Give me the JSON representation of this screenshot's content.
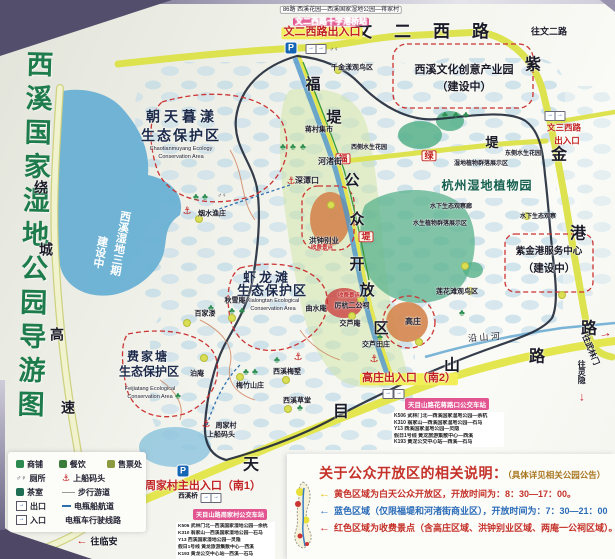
{
  "title": {
    "text": "西溪国家湿地公园导游图"
  },
  "colors": {
    "title_green": "#1e7c4c",
    "road_yellow": "#dde24f",
    "expressway_pale": "#eef0c2",
    "water_blue": "#69b0d4",
    "boundary_dark": "#1f2838",
    "paid_red": "#cc3333",
    "open_area_green": "#cde3a4",
    "badge_pink": "#e25590",
    "entrance_red": "#c22222"
  },
  "map": {
    "labels": [
      {
        "n": "road-wener-west",
        "t": "文二西路",
        "x": 433,
        "y": 32,
        "fs": 17,
        "ls": 22
      },
      {
        "n": "dir-to-wenerlu",
        "t": "往文二路",
        "x": 549,
        "y": 32,
        "fs": 9
      },
      {
        "n": "bus-note-top",
        "t": "86路 西溪花园—西溪国家湿地公园—蒋家村",
        "x": 341,
        "y": 10,
        "fs": 6,
        "b": 0,
        "bg": "#ffffff",
        "bd": "#aaaaaa"
      },
      {
        "n": "station-badge-top",
        "t": "文二西路十字港桥站",
        "x": 331,
        "y": 22,
        "fs": 8,
        "c": "#ffffff",
        "bg": "#e25590"
      },
      {
        "n": "entrance-wener",
        "t": "文二西路出入口",
        "x": 322,
        "y": 33,
        "fs": 11,
        "c": "#c22222",
        "bg": "#f2ee55"
      },
      {
        "n": "road-zijingang-1",
        "t": "紫",
        "x": 533,
        "y": 66,
        "fs": 16
      },
      {
        "n": "road-zijingang-2",
        "t": "金",
        "x": 559,
        "y": 156,
        "fs": 16
      },
      {
        "n": "road-zijingang-3",
        "t": "港",
        "x": 578,
        "y": 235,
        "fs": 16
      },
      {
        "n": "road-zijingang-4",
        "t": "路",
        "x": 589,
        "y": 330,
        "fs": 16
      },
      {
        "n": "creative-park-1",
        "t": "西溪文化创意产业园",
        "x": 464,
        "y": 71,
        "fs": 11
      },
      {
        "n": "creative-park-2",
        "t": "（建设中）",
        "x": 464,
        "y": 88,
        "fs": 11
      },
      {
        "n": "qianjinyang-bird-area",
        "t": "千金漾观鸟区",
        "x": 352,
        "y": 68,
        "fs": 7
      },
      {
        "n": "fudi-1",
        "t": "福",
        "x": 313,
        "y": 85,
        "fs": 15
      },
      {
        "n": "fudi-2",
        "t": "堤",
        "x": 334,
        "y": 118,
        "fs": 15
      },
      {
        "n": "fudi-badge-1",
        "t": "福",
        "x": 343,
        "y": 159,
        "fs": 9,
        "c": "#c22222",
        "bd": "#cc3333",
        "bg": "#fff8e8"
      },
      {
        "n": "fudi-badge-2",
        "t": "堤",
        "x": 366,
        "y": 237,
        "fs": 9,
        "c": "#c22222",
        "bd": "#cc3333",
        "bg": "#fff8e8"
      },
      {
        "n": "ludi-badge",
        "t": "绿",
        "x": 429,
        "y": 156,
        "fs": 9,
        "c": "#c22222",
        "bd": "#cc3333",
        "bg": "#fff8e8"
      },
      {
        "n": "ludi-di",
        "t": "堤",
        "x": 492,
        "y": 143,
        "fs": 13
      },
      {
        "n": "open-area-1",
        "t": "公",
        "x": 352,
        "y": 181,
        "fs": 15
      },
      {
        "n": "open-area-2",
        "t": "众",
        "x": 357,
        "y": 220,
        "fs": 15
      },
      {
        "n": "open-area-3",
        "t": "开",
        "x": 357,
        "y": 265,
        "fs": 15
      },
      {
        "n": "open-area-4",
        "t": "放",
        "x": 367,
        "y": 291,
        "fs": 15
      },
      {
        "n": "open-area-5",
        "t": "区",
        "x": 381,
        "y": 329,
        "fs": 15
      },
      {
        "n": "jiangcun-market",
        "t": "蒋村集市",
        "x": 319,
        "y": 130,
        "fs": 7
      },
      {
        "n": "hezhu-street",
        "t": "河渚街",
        "x": 330,
        "y": 162,
        "fs": 8
      },
      {
        "n": "shentankou",
        "t": "深潭口",
        "x": 307,
        "y": 181,
        "fs": 8
      },
      {
        "n": "west-water-garden",
        "t": "西侧水生花园",
        "x": 369,
        "y": 148,
        "fs": 6
      },
      {
        "n": "east-water-garden",
        "t": "东侧水生花园",
        "x": 523,
        "y": 154,
        "fs": 6
      },
      {
        "n": "wetland-plant-display",
        "t": "湿地植物群落展示区",
        "x": 481,
        "y": 164,
        "fs": 6
      },
      {
        "n": "botanical-garden",
        "t": "杭州湿地植物园",
        "x": 487,
        "y": 186,
        "fs": 12,
        "c": "#16604e",
        "ls": 1
      },
      {
        "n": "underwater-gallery",
        "t": "水下生态观察廊",
        "x": 451,
        "y": 207,
        "fs": 6
      },
      {
        "n": "aquatic-plant-display",
        "t": "水生植物群落展示区",
        "x": 440,
        "y": 224,
        "fs": 6
      },
      {
        "n": "underwater-observe",
        "t": "水下生态观察",
        "x": 538,
        "y": 217,
        "fs": 6
      },
      {
        "n": "entrance-wensan-1",
        "t": "文三西路",
        "x": 564,
        "y": 128,
        "fs": 8.5,
        "c": "#c22222"
      },
      {
        "n": "entrance-wensan-2",
        "t": "出入口",
        "x": 567,
        "y": 141,
        "fs": 8.5,
        "c": "#c22222"
      },
      {
        "n": "zjg-service-1",
        "t": "紫金港服务中心",
        "x": 549,
        "y": 252,
        "fs": 9.5
      },
      {
        "n": "zjg-service-2",
        "t": "（建设中）",
        "x": 549,
        "y": 269,
        "fs": 10.5
      },
      {
        "n": "lianhuatan-bird-area",
        "t": "莲花滩观鸟区",
        "x": 457,
        "y": 292,
        "fs": 7
      },
      {
        "n": "chaotianmuyang-1",
        "t": "朝天暮漾",
        "x": 182,
        "y": 117,
        "fs": 14,
        "c": "#1c2a4a",
        "ls": 4
      },
      {
        "n": "chaotianmuyang-2",
        "t": "生态保护区",
        "x": 181,
        "y": 136,
        "fs": 14,
        "c": "#1c2a4a",
        "ls": 2
      },
      {
        "n": "chaotianmuyang-en1",
        "t": "Chaotianmuyang Ecology",
        "x": 181,
        "y": 150,
        "fs": 5.5,
        "b": 0,
        "c": "#222233"
      },
      {
        "n": "chaotianmuyang-en2",
        "t": "Conservation Area",
        "x": 181,
        "y": 158,
        "fs": 5.5,
        "b": 0,
        "c": "#222233"
      },
      {
        "n": "phase3-1",
        "t": "西溪湿地三期",
        "x": 119,
        "y": 243,
        "fs": 11,
        "c": "#ffffff",
        "v": 1,
        "r": 10,
        "halo": 0
      },
      {
        "n": "phase3-2",
        "t": "建设中",
        "x": 99,
        "y": 252,
        "fs": 11,
        "c": "#ffffff",
        "v": 1,
        "r": 10,
        "halo": 0
      },
      {
        "n": "xialongtan-1",
        "t": "虾龙滩",
        "x": 267,
        "y": 278,
        "fs": 13,
        "c": "#1c2a4a",
        "ls": 3
      },
      {
        "n": "xialongtan-2",
        "t": "生态保护区",
        "x": 272,
        "y": 291,
        "fs": 13,
        "c": "#1c2a4a",
        "ls": 1
      },
      {
        "n": "xialongtan-en1",
        "t": "Xialongtan Ecological",
        "x": 273,
        "y": 302,
        "fs": 5.5,
        "b": 0,
        "c": "#222233"
      },
      {
        "n": "xialongtan-en2",
        "t": "Conservation Area",
        "x": 273,
        "y": 310,
        "fs": 5.5,
        "b": 0,
        "c": "#222233"
      },
      {
        "n": "qiuxuean",
        "t": "秋雪庵",
        "x": 235,
        "y": 301,
        "fs": 7
      },
      {
        "n": "baijialou",
        "t": "百家溇",
        "x": 205,
        "y": 314,
        "fs": 7
      },
      {
        "n": "boan",
        "t": "泊庵",
        "x": 197,
        "y": 374,
        "fs": 7
      },
      {
        "n": "meizhu-shanzhuang",
        "t": "梅竹山庄",
        "x": 250,
        "y": 386,
        "fs": 7
      },
      {
        "n": "xixi-meishu",
        "t": "西溪梅墅",
        "x": 287,
        "y": 372,
        "fs": 7
      },
      {
        "n": "xixi-caotang",
        "t": "西溪草堂",
        "x": 297,
        "y": 401,
        "fs": 7
      },
      {
        "n": "feijiatang-1",
        "t": "费家塘",
        "x": 148,
        "y": 357,
        "fs": 12,
        "c": "#1c2a4a",
        "ls": 2
      },
      {
        "n": "feijiatang-2",
        "t": "生态保护区",
        "x": 149,
        "y": 372,
        "fs": 12,
        "c": "#1c2a4a"
      },
      {
        "n": "feijiatang-en1",
        "t": "Feijiatang Ecological",
        "x": 150,
        "y": 390,
        "fs": 5.5,
        "b": 0,
        "c": "#222233"
      },
      {
        "n": "feijiatang-en2",
        "t": "Conservation Area",
        "x": 150,
        "y": 398,
        "fs": 5.5,
        "b": 0,
        "c": "#222233"
      },
      {
        "n": "yanshui-yuzhuang",
        "t": "烟水渔庄",
        "x": 212,
        "y": 214,
        "fs": 7
      },
      {
        "n": "zhoujiacun",
        "t": "周家村",
        "x": 226,
        "y": 426,
        "fs": 7
      },
      {
        "n": "boarding-dock",
        "t": "上船码头",
        "x": 221,
        "y": 435,
        "fs": 7
      },
      {
        "n": "hongzhong-bieye",
        "t": "洪钟别业",
        "x": 324,
        "y": 241,
        "fs": 7.5
      },
      {
        "n": "paid-spot-1",
        "t": "收费景点",
        "x": 322,
        "y": 249,
        "fs": 5.5,
        "c": "#c22222"
      },
      {
        "n": "qushuian",
        "t": "曲水庵",
        "x": 316,
        "y": 309,
        "fs": 7
      },
      {
        "n": "lihang-ergongci",
        "t": "厉杭二公祠",
        "x": 352,
        "y": 306,
        "fs": 7
      },
      {
        "n": "paid-spot-2",
        "t": "收费景点",
        "x": 349,
        "y": 297,
        "fs": 5.5,
        "c": "#c22222"
      },
      {
        "n": "jiaoluan",
        "t": "交芦庵",
        "x": 350,
        "y": 324,
        "fs": 7
      },
      {
        "n": "jiaolu-tianzhuang",
        "t": "交芦田庄",
        "x": 376,
        "y": 345,
        "fs": 7
      },
      {
        "n": "gaozhuang",
        "t": "高庄",
        "x": 413,
        "y": 322,
        "fs": 8
      },
      {
        "n": "entrance-gaozhuang",
        "t": "高庄出入口（南2）",
        "x": 409,
        "y": 379,
        "fs": 11,
        "c": "#c22222",
        "bg": "#f2ee55"
      },
      {
        "n": "entrance-zhoujiacun",
        "t": "周家村主出入口（南1）",
        "x": 203,
        "y": 487,
        "fs": 11,
        "c": "#c22222"
      },
      {
        "n": "xixi-bridge",
        "t": "西溪桥",
        "x": 188,
        "y": 497,
        "fs": 6.5
      },
      {
        "n": "road-tianmushan-1",
        "t": "天",
        "x": 251,
        "y": 466,
        "fs": 16
      },
      {
        "n": "road-tianmushan-2",
        "t": "目",
        "x": 341,
        "y": 413,
        "fs": 16
      },
      {
        "n": "road-tianmushan-3",
        "t": "山",
        "x": 452,
        "y": 367,
        "fs": 16
      },
      {
        "n": "road-tianmushan-4",
        "t": "路",
        "x": 537,
        "y": 358,
        "fs": 16
      },
      {
        "n": "yanshan-river",
        "t": "沿 山 河",
        "x": 484,
        "y": 338,
        "fs": 9,
        "b": 0,
        "r": -4
      },
      {
        "n": "road-raocheng-1",
        "t": "绕",
        "x": 41,
        "y": 188,
        "fs": 14
      },
      {
        "n": "road-raocheng-2",
        "t": "城",
        "x": 46,
        "y": 250,
        "fs": 14
      },
      {
        "n": "road-raocheng-3",
        "t": "高",
        "x": 57,
        "y": 335,
        "fs": 14
      },
      {
        "n": "road-raocheng-4",
        "t": "速",
        "x": 68,
        "y": 408,
        "fs": 14
      },
      {
        "n": "dir-to-wulinmen",
        "t": "往武林门",
        "x": 590,
        "y": 350,
        "fs": 8,
        "r": 68
      },
      {
        "n": "dir-to-wulinmen-arrow",
        "t": "→",
        "x": 605,
        "y": 333,
        "fs": 13,
        "c": "#c22222",
        "r": -12
      },
      {
        "n": "dir-to-lingyin",
        "t": "往灵隐",
        "x": 581,
        "y": 372,
        "fs": 8,
        "v": 1
      },
      {
        "n": "dir-to-lingyin-arrow",
        "t": "↓",
        "x": 582,
        "y": 397,
        "fs": 12,
        "c": "#c22222"
      },
      {
        "n": "dir-to-linan-arrow",
        "t": "←",
        "x": 82,
        "y": 542,
        "fs": 11,
        "c": "#c22222"
      },
      {
        "n": "dir-to-linan",
        "t": "往临安",
        "x": 104,
        "y": 542,
        "fs": 9
      },
      {
        "n": "liuxia-exit",
        "t": "留下出口",
        "x": 130,
        "y": 514,
        "fs": 8,
        "c": "#c22222",
        "r": -32
      }
    ],
    "icons": [
      {
        "n": "parking-icon",
        "g": "p",
        "x": 291,
        "y": 48
      },
      {
        "n": "parking-icon",
        "g": "p",
        "x": 183,
        "y": 471
      },
      {
        "n": "entrance-icon",
        "g": "box",
        "x": 311,
        "y": 49
      },
      {
        "n": "exit-icon",
        "g": "box",
        "x": 321,
        "y": 49
      },
      {
        "n": "toilet-icon",
        "g": "wc",
        "x": 334,
        "y": 50
      },
      {
        "n": "entrance-icon",
        "g": "box",
        "x": 550,
        "y": 116
      },
      {
        "n": "exit-icon",
        "g": "box",
        "x": 560,
        "y": 116
      },
      {
        "n": "entrance-icon",
        "g": "box",
        "x": 388,
        "y": 394
      },
      {
        "n": "exit-icon",
        "g": "box",
        "x": 399,
        "y": 394
      },
      {
        "n": "entrance-icon",
        "g": "box",
        "x": 206,
        "y": 498
      },
      {
        "n": "exit-icon",
        "g": "box",
        "x": 216,
        "y": 498
      },
      {
        "n": "dock-anchor-icon",
        "g": "anchor",
        "x": 187,
        "y": 212
      },
      {
        "n": "dock-anchor-icon",
        "g": "anchor",
        "x": 291,
        "y": 182
      },
      {
        "n": "dock-anchor-icon",
        "g": "anchor",
        "x": 374,
        "y": 360
      },
      {
        "n": "dock-anchor-icon",
        "g": "anchor",
        "x": 298,
        "y": 358
      },
      {
        "n": "dock-anchor-icon",
        "g": "anchor",
        "x": 206,
        "y": 425
      },
      {
        "n": "toilet-icon",
        "g": "wc",
        "x": 222,
        "y": 196
      },
      {
        "n": "tree-icon",
        "g": "tree",
        "x": 196,
        "y": 197
      },
      {
        "n": "tree-icon",
        "g": "tree",
        "x": 205,
        "y": 197
      },
      {
        "n": "tree-icon",
        "g": "tree",
        "x": 283,
        "y": 147
      },
      {
        "n": "tree-icon",
        "g": "tree",
        "x": 293,
        "y": 147
      },
      {
        "n": "tree-icon",
        "g": "tree",
        "x": 303,
        "y": 147
      },
      {
        "n": "tree-icon",
        "g": "tree",
        "x": 232,
        "y": 311
      },
      {
        "n": "tree-icon",
        "g": "tree",
        "x": 242,
        "y": 311
      },
      {
        "n": "tree-icon",
        "g": "tree",
        "x": 211,
        "y": 308
      },
      {
        "n": "tree-icon",
        "g": "tree",
        "x": 246,
        "y": 372
      },
      {
        "n": "tree-icon",
        "g": "tree",
        "x": 255,
        "y": 372
      },
      {
        "n": "tree-icon",
        "g": "tree",
        "x": 277,
        "y": 360
      },
      {
        "n": "tree-icon",
        "g": "tree",
        "x": 300,
        "y": 408
      },
      {
        "n": "tree-icon",
        "g": "tree",
        "x": 445,
        "y": 115
      },
      {
        "n": "tree-icon",
        "g": "tree",
        "x": 456,
        "y": 115
      },
      {
        "n": "tree-icon",
        "g": "tree",
        "x": 466,
        "y": 115
      },
      {
        "n": "tree-icon",
        "g": "tree",
        "x": 380,
        "y": 337
      },
      {
        "n": "tree-icon",
        "g": "tree",
        "x": 178,
        "y": 396
      },
      {
        "n": "tree-icon",
        "g": "tree",
        "x": 462,
        "y": 313
      }
    ],
    "dots": [
      [
        338,
        70
      ],
      [
        199,
        219
      ],
      [
        232,
        318
      ],
      [
        187,
        323
      ],
      [
        204,
        358
      ],
      [
        240,
        377
      ],
      [
        286,
        380
      ],
      [
        288,
        409
      ],
      [
        361,
        299
      ],
      [
        419,
        342
      ],
      [
        470,
        291
      ],
      [
        562,
        295
      ],
      [
        527,
        216
      ],
      [
        331,
        205
      ],
      [
        352,
        316
      ],
      [
        465,
        266
      ]
    ]
  },
  "bus": {
    "stations": [
      {
        "badge": "天目山路花蒋路口公交车站",
        "routes": [
          "K506 武林门北—西溪国家湿地公园—余杭",
          "K310 翁家山—西溪国家湿地公园—石马",
          "Y13 西溪国家湿地公园—灵隐",
          "假日1号线 黄龙旅游集散中心—西溪",
          "K193 黄龙公交中心站—西溪—石马"
        ]
      },
      {
        "badge": "天目山路周家村公交车站",
        "routes": [
          "K506 武林门北—西溪国家湿地公园—余杭",
          "K310 翁家山—西溪国家湿地公园—石马",
          "Y13 西溪国家湿地公园—灵隐",
          "假日1号线 黄龙旅游集散中心—西溪",
          "K193 黄龙公交中心站—西溪—石马"
        ]
      }
    ]
  },
  "legend": {
    "rows": [
      [
        {
          "i": "shop",
          "t": "商铺"
        },
        {
          "i": "food",
          "t": "餐饮"
        },
        {
          "i": "ticket",
          "t": "售票处"
        }
      ],
      [
        {
          "i": "wc",
          "t": "厕所"
        },
        {
          "i": "anchor",
          "t": "上船码头"
        }
      ],
      [
        {
          "i": "tea",
          "t": "茶室"
        },
        {
          "i": "path",
          "t": "步行游道"
        }
      ],
      [
        {
          "i": "exit",
          "t": "出口"
        },
        {
          "i": "boat",
          "t": "电瓶船航道"
        }
      ],
      [
        {
          "i": "enter",
          "t": "入口"
        },
        {
          "i": "cart",
          "t": "电瓶车行驶线路"
        }
      ]
    ]
  },
  "notice": {
    "title": "关于公众开放区的相关说明：",
    "title_note": "（具体详见相关公园公告）",
    "bullets": [
      {
        "arrow": "#e8c21a",
        "tc": "#c5322a",
        "text": "黄色区域为白天公众开放区，开放时间为：8：30—17：00。"
      },
      {
        "arrow": "#3b7cc4",
        "tc": "#2b6cb8",
        "text": "蓝色区域（仅限福堤和河渚街商业区），开放时间为：7：30—21：00"
      },
      {
        "arrow": "#cc3333",
        "tc": "#c5322a",
        "text": "红色区域为收费景点（含高庄区域、洪钟别业区域、两庵一公祠区域）。"
      }
    ]
  }
}
